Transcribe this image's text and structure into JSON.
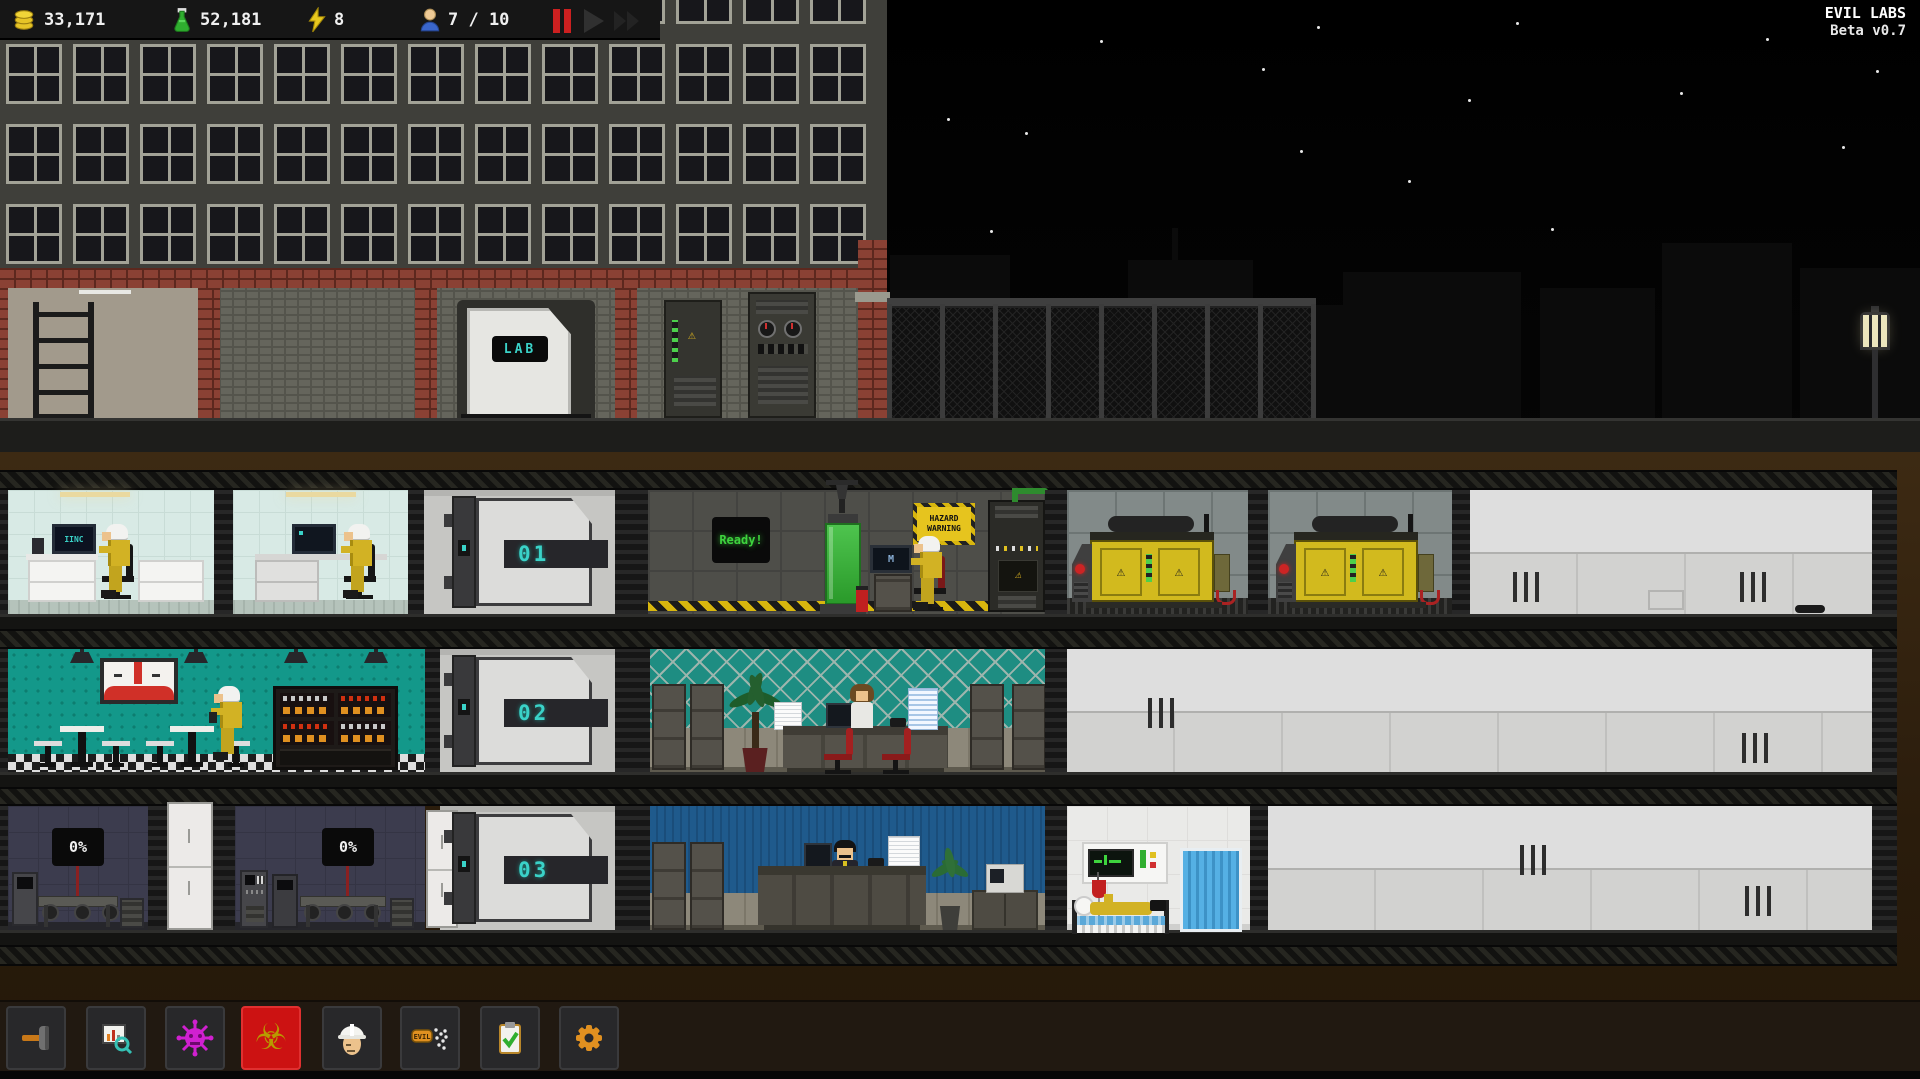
{
  "app": {
    "title": "EVIL LABS",
    "version": "Beta v0.7"
  },
  "hud": {
    "money": "33,171",
    "research": "52,181",
    "energy": "8",
    "staff": "7 / 10",
    "icons": {
      "money": "coins-icon",
      "research": "flask-icon",
      "energy": "bolt-icon",
      "staff": "person-icon"
    },
    "speed_controls": [
      "pause",
      "play",
      "fast-forward"
    ]
  },
  "surface": {
    "lab_door_sign": "LAB"
  },
  "floors": {
    "f1": {
      "elevator": "01",
      "lab_monitor": "IINC",
      "workstation_monitor": "M",
      "ready_sign": "Ready!",
      "hazard_line1": "HAZARD",
      "hazard_line2": "WARNING"
    },
    "f2": {
      "elevator": "02"
    },
    "f3": {
      "elevator": "03",
      "machine_a_progress": "0%",
      "machine_b_progress": "0%"
    }
  },
  "toolbar": {
    "selected_id": "biohazard",
    "buttons": [
      {
        "id": "build",
        "icon": "hammer-icon"
      },
      {
        "id": "research",
        "icon": "chart-magnifier-icon"
      },
      {
        "id": "virus",
        "icon": "virus-icon"
      },
      {
        "id": "biohazard",
        "icon": "biohazard-icon",
        "glyph": "☣"
      },
      {
        "id": "staff",
        "icon": "hardhat-icon"
      },
      {
        "id": "propaganda",
        "icon": "evil-spray-icon",
        "badge_text": "EVIL"
      },
      {
        "id": "tasks",
        "icon": "clipboard-check-icon"
      },
      {
        "id": "settings",
        "icon": "gear-icon"
      }
    ]
  },
  "colors": {
    "accent_teal": "#3ad2c8",
    "hazard_yellow": "#e6c41e",
    "selected_red": "#cc1212",
    "ready_green": "#3ed43e",
    "generator_yellow": "#d2ba1e",
    "cafeteria_teal": "#13988a",
    "boss_blue": "#1f5a8c",
    "medical_blue": "#4aa8e0"
  }
}
